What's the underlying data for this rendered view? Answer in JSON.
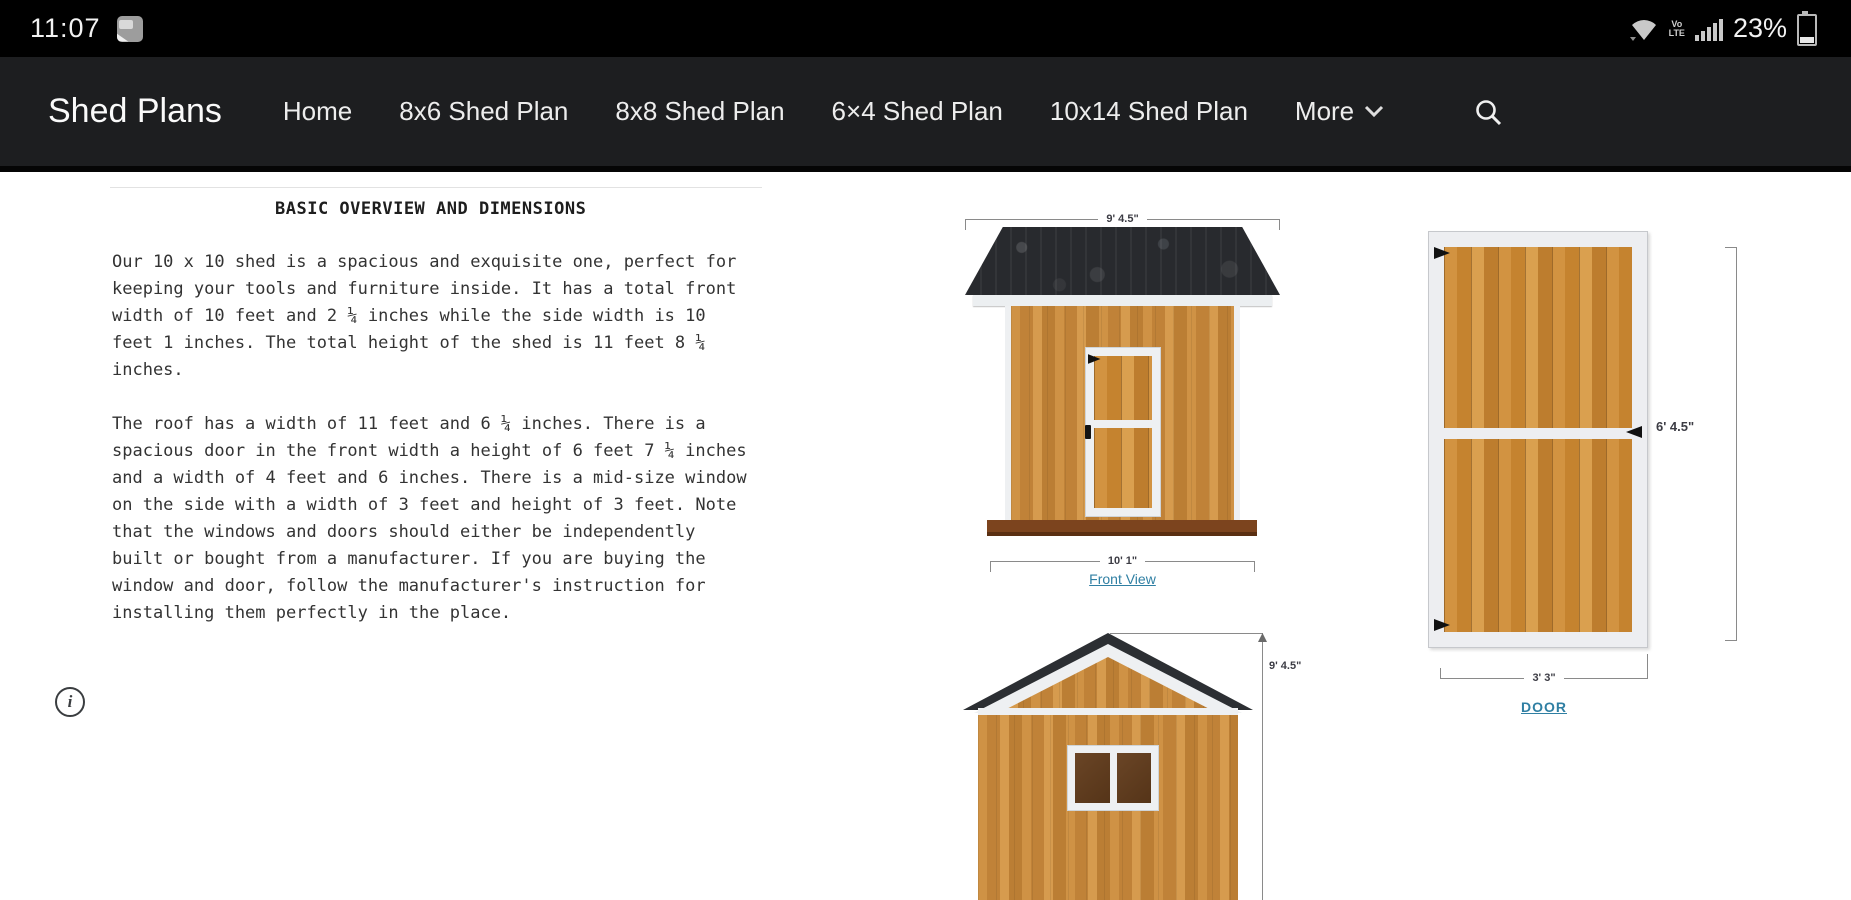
{
  "status_bar": {
    "time": "11:07",
    "battery": "23%",
    "volte_line1": "Vo",
    "volte_line2": "LTE"
  },
  "nav": {
    "brand": "Shed Plans",
    "items": [
      "Home",
      "8x6 Shed Plan",
      "8x8 Shed Plan",
      "6×4 Shed Plan",
      "10x14 Shed Plan"
    ],
    "more_label": "More"
  },
  "article": {
    "heading": "BASIC OVERVIEW AND DIMENSIONS",
    "paragraph1": "Our 10 x 10 shed is a spacious and exquisite one, perfect for\nkeeping your tools and furniture inside. It has a total front\nwidth of 10 feet and 2 ¼ inches while the side width is 10\nfeet 1 inches. The total height of the shed is 11 feet 8 ¼\ninches.",
    "paragraph2": "The roof has a width of 11 feet and 6 ¼ inches. There is a\nspacious door in the front width a height of 6 feet 7 ¼ inches\nand a width of 4 feet and 6 inches. There is a mid-size window\non the side with a width of 3 feet and height of 3 feet. Note\nthat the windows and doors should either be independently\nbuilt or bought from a manufacturer. If you are buying the\nwindow and door, follow the manufacturer's instruction for\ninstalling them perfectly in the place.",
    "info_glyph": "i"
  },
  "figures": {
    "front_view": {
      "top_dim": "9' 4.5\"",
      "bottom_dim": "10' 1\"",
      "link": "Front View"
    },
    "door": {
      "height_dim": "6' 4.5\"",
      "width_dim": "3' 3\"",
      "link": "DOOR"
    },
    "side_view": {
      "height_dim": "9' 4.5\""
    }
  },
  "colors": {
    "accent_link": "#2f7fa3",
    "nav_bg": "#1d1e20",
    "wood": "#c6873d",
    "roof": "#282a2e",
    "base_brown": "#7c441e"
  }
}
